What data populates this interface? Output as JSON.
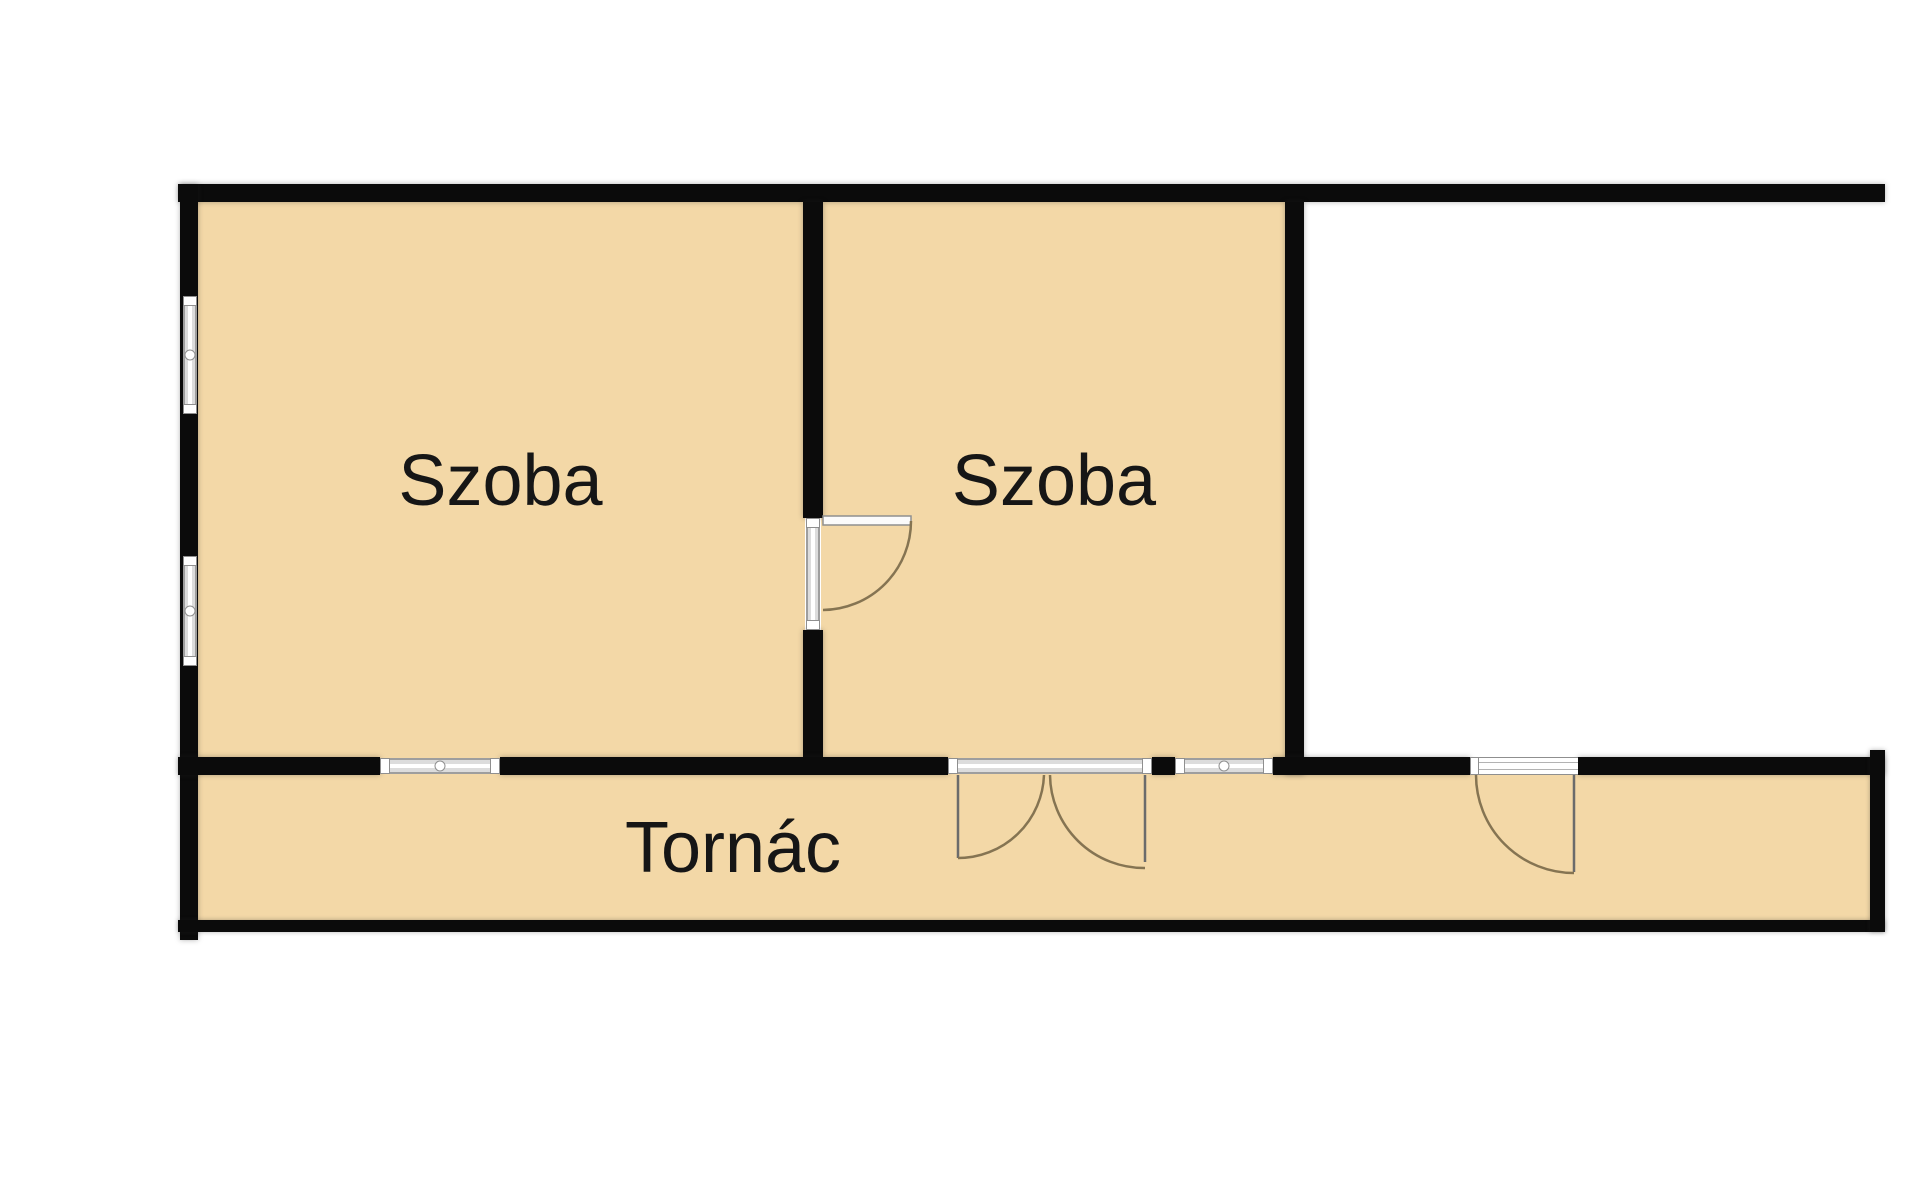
{
  "plan": {
    "title": "Floor plan",
    "rooms": [
      {
        "id": "szoba-1",
        "label": "Szoba"
      },
      {
        "id": "szoba-2",
        "label": "Szoba"
      },
      {
        "id": "tornac",
        "label": "Tornác"
      },
      {
        "id": "unlabeled-room",
        "label": ""
      }
    ],
    "elements": {
      "windows": [
        "left-wall-upper-window",
        "left-wall-lower-window",
        "szoba1-south-window",
        "szoba2-south-window"
      ],
      "doors": [
        "szoba1-to-szoba2-door",
        "double-door-to-tornac",
        "right-room-to-tornac-door"
      ]
    },
    "colors": {
      "floor_fill": "#f3d8a7",
      "wall": "#0b0b0b",
      "door_arc": "#857452",
      "window_frame": "#9e9e9e",
      "background": "#ffffff",
      "label_text": "#161616"
    }
  }
}
